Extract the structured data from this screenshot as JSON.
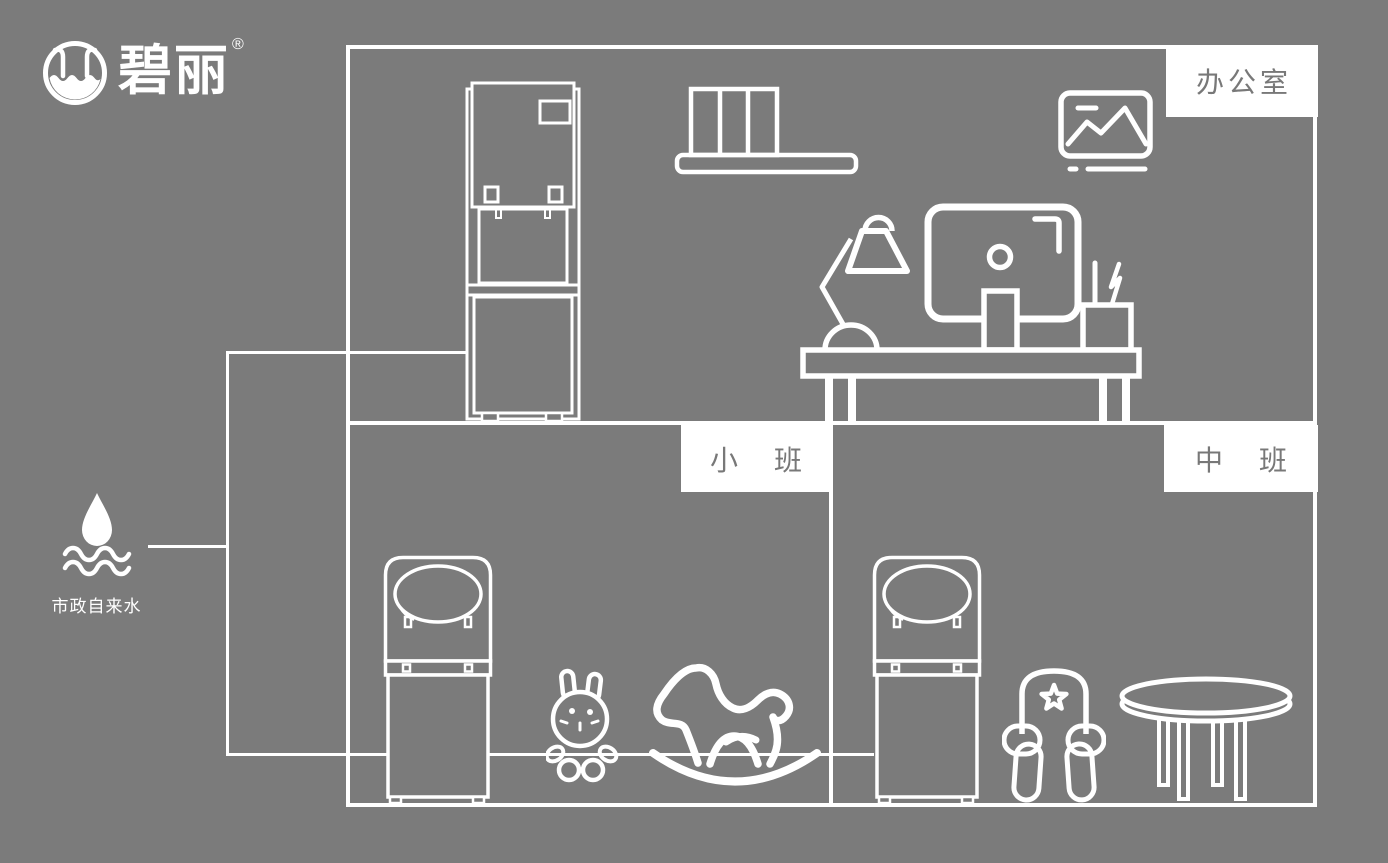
{
  "page": {
    "background_color": "#7b7b7b",
    "line_color": "#ffffff",
    "label_text_color": "#787878",
    "description": "Water dispenser installation diagram for kindergarten rooms"
  },
  "brand": {
    "name": "碧丽",
    "registered_mark": "®",
    "logo_icon": "water-cup-circle-icon"
  },
  "water_source": {
    "label": "市政自来水",
    "icon": "water-drop-waves-icon"
  },
  "rooms": {
    "office": {
      "label": "办公室",
      "items": [
        "standing-water-dispenser",
        "bookshelf",
        "picture-frame",
        "desk-lamp",
        "computer-monitor",
        "pen-holder",
        "office-desk"
      ]
    },
    "junior": {
      "label": "小　班",
      "items": [
        "kindergarten-water-dispenser",
        "rabbit-toy",
        "rocking-horse"
      ]
    },
    "middle": {
      "label": "中　班",
      "items": [
        "kindergarten-water-dispenser",
        "kids-chair",
        "round-table"
      ]
    }
  },
  "piping": {
    "source_to_riser": "horizontal",
    "riser": "vertical",
    "office_branch": "horizontal",
    "classroom_branch": "horizontal"
  }
}
